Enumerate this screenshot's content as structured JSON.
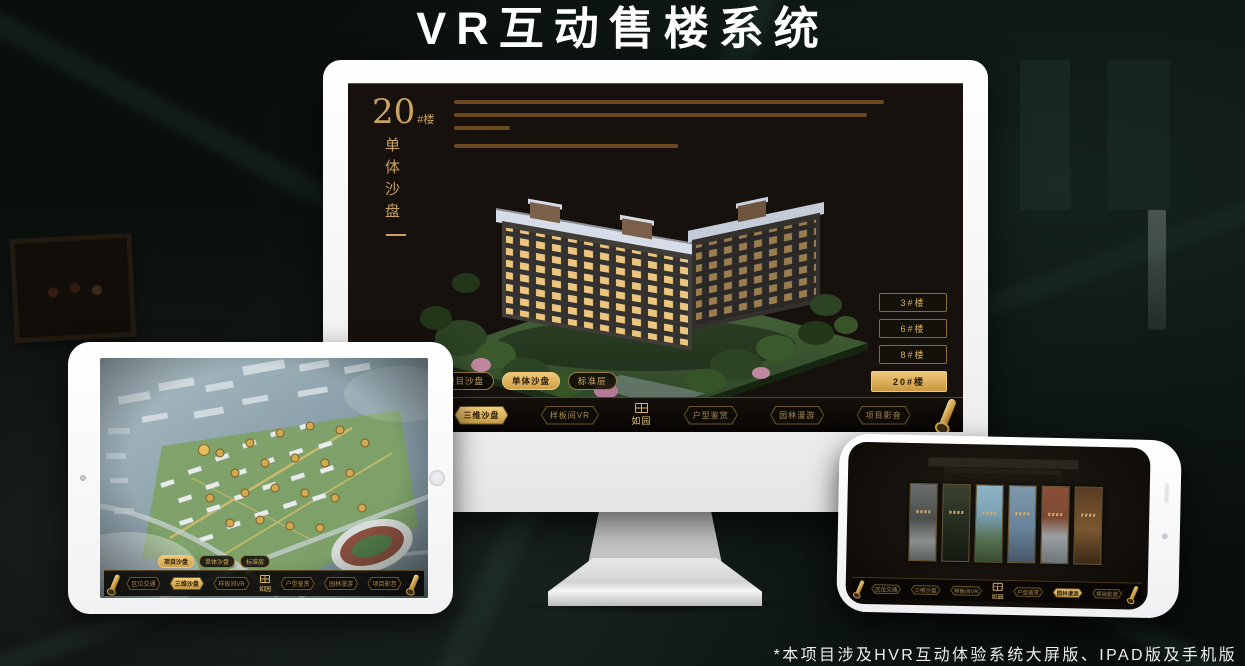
{
  "page": {
    "title": "VR互动售楼系统",
    "footnote": "*本项目涉及HVR互动体验系统大屏版、IPAD版及手机版"
  },
  "colors": {
    "gold": "#d4aa5e",
    "gold_bright": "#eec878",
    "dark_text": "#2a1c08",
    "screen_bg": "#17110d",
    "background": "#0a0f0c"
  },
  "brand": {
    "logo_text": "如园"
  },
  "system_menu": {
    "items": [
      {
        "label": "区位交通"
      },
      {
        "label": "三维沙盘"
      },
      {
        "label": "样板间VR"
      },
      {
        "label": "户型鉴赏"
      },
      {
        "label": "园林漫游"
      },
      {
        "label": "项目影音"
      }
    ]
  },
  "monitor": {
    "heading": {
      "number": "20",
      "suffix": "#楼",
      "subtitle": "单体沙盘"
    },
    "sub_tabs": [
      {
        "label": "项目沙盘",
        "active": false
      },
      {
        "label": "单体沙盘",
        "active": true
      },
      {
        "label": "标准层",
        "active": false
      }
    ],
    "building_buttons": [
      {
        "label": "3#楼",
        "active": false
      },
      {
        "label": "6#楼",
        "active": false
      },
      {
        "label": "8#楼",
        "active": false
      },
      {
        "label": "20#楼",
        "active": true
      }
    ],
    "active_menu_item": "三维沙盘"
  },
  "tablet": {
    "sub_tabs": [
      {
        "label": "项目沙盘",
        "active": true
      },
      {
        "label": "单体沙盘",
        "active": false
      },
      {
        "label": "标准层",
        "active": false
      }
    ],
    "active_menu_item": "三维沙盘"
  },
  "phone": {
    "active_menu_item": "园林漫游"
  }
}
